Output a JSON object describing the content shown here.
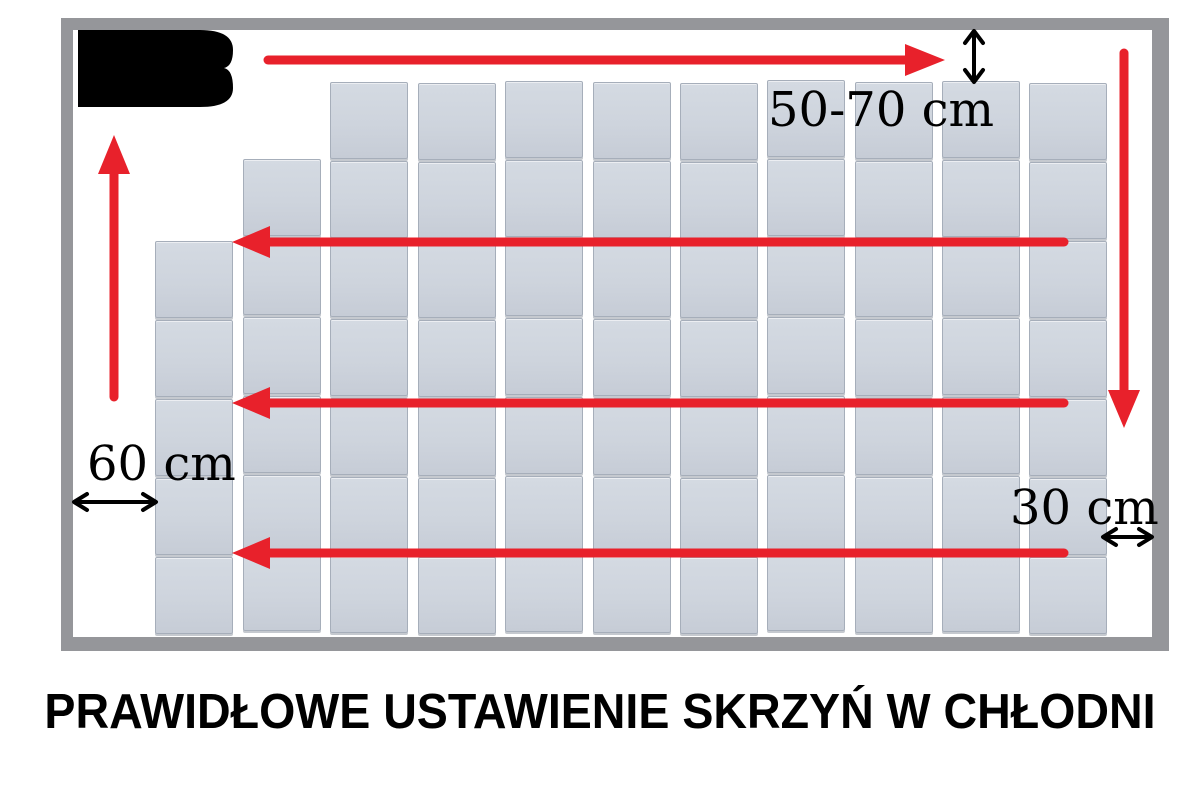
{
  "caption": "PRAWIDŁOWE USTAWIENIE SKRZYŃ W CHŁODNI",
  "measurements": {
    "top_gap": "50-70 cm",
    "left_gap": "60 cm",
    "right_gap": "30 cm"
  },
  "icons": {
    "cooling_unit": "cooling-unit-black-block",
    "airflow": "red-airflow-arrows",
    "measure": "black-double-headed-measure-arrows"
  },
  "colors": {
    "arrow_red": "#e8212b",
    "wall_gray": "#95969a",
    "crate_fill": "#ced4dd",
    "crate_edge": "#a6aeba",
    "text_black": "#000000",
    "background": "#ffffff"
  },
  "crate_grid": {
    "crate_width": 78,
    "crate_height": 77,
    "column_x": [
      155,
      243,
      330,
      418,
      505,
      593,
      680,
      767,
      855,
      942,
      1029
    ],
    "row_y": [
      82,
      161,
      240,
      319,
      398,
      477,
      556
    ],
    "column_start_row": [
      2,
      1,
      0,
      0,
      0,
      0,
      0,
      0,
      0,
      0,
      0
    ],
    "column_y_offset": [
      1,
      -2,
      0,
      1,
      -1,
      0,
      1,
      -2,
      0,
      -1,
      1
    ]
  }
}
